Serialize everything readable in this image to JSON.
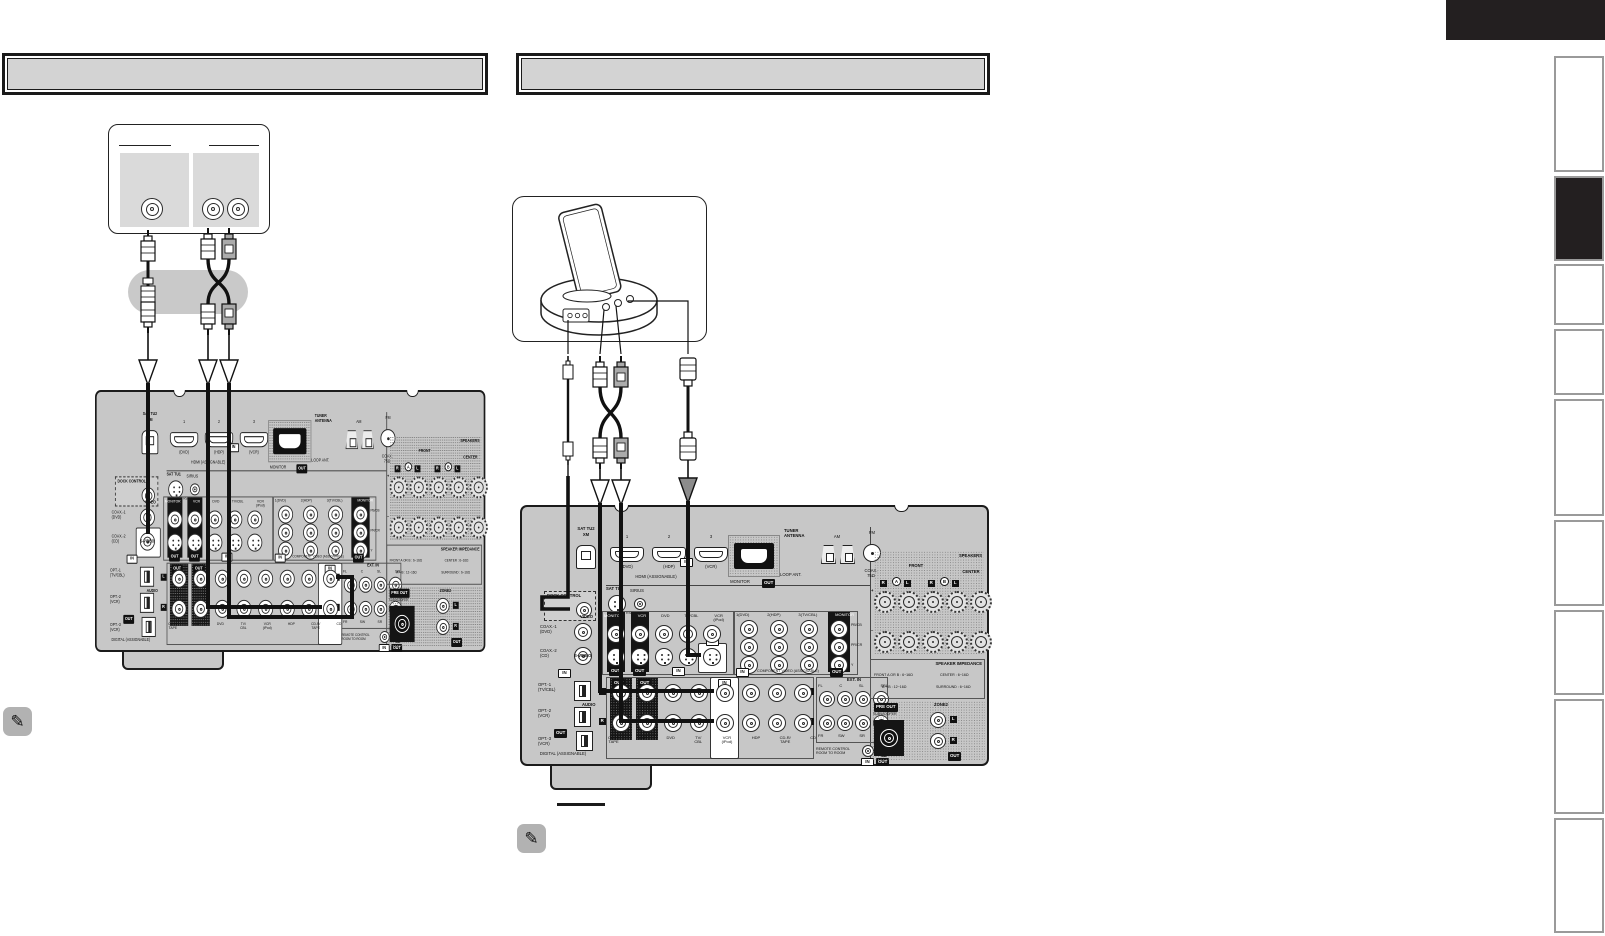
{
  "page": {
    "headers": [
      {
        "title": ""
      },
      {
        "title": ""
      }
    ],
    "top_corner_tab": {
      "color": "#231f20"
    },
    "sidebar": {
      "tab_count": 9,
      "active_tab_index": 2,
      "border_color": "#9a9a9a",
      "active_color": "#231f20"
    },
    "notes": {
      "icon": "✎"
    }
  },
  "left_diagram": {
    "player_jacks": 3,
    "cables": [
      "coaxial-digital",
      "stereo-audio"
    ]
  },
  "right_diagram": {
    "dock_jacks": 3,
    "cables": [
      "dock-control",
      "stereo-audio",
      "s-video"
    ]
  },
  "receiver": {
    "xm": {
      "label1": "SAT TU2",
      "label2": "XM"
    },
    "hdmi": {
      "ports": [
        {
          "num": "1",
          "sub": "(DVD)"
        },
        {
          "num": "2",
          "sub": "(HDP)"
        },
        {
          "num": "3",
          "sub": "(VCR)"
        }
      ],
      "group": "HDMI (ASSIGNABLE)",
      "monitor": "MONITOR"
    },
    "badges": {
      "in": "IN",
      "out": "OUT",
      "l": "L",
      "r": "R"
    },
    "tuner": {
      "title": "TUNER\nANTENNA",
      "am": "AM",
      "fm": "FM",
      "loop": "LOOP ANT.",
      "coax": "COAX.\n75Ω"
    },
    "speakers": {
      "title": "SPEAKERS",
      "front": "FRONT",
      "center": "CENTER",
      "a": "A",
      "b": "B",
      "plus": "+",
      "minus": "−"
    },
    "dock": {
      "label": "DOCK CONTROL"
    },
    "digital": {
      "coax1": "COAX.-1\n(DVD)",
      "coax2": "COAX.-2\n(CD)",
      "opt1": "OPT.-1\n(TV/CBL)",
      "opt2": "OPT.-2\n(VCR)",
      "opt3": "OPT.-3\n(VCR)",
      "group": "DIGITAL (ASSIGNABLE)"
    },
    "sat": {
      "label": "SAT TU1",
      "sirius": "SIRIUS",
      "rc": "RS/RC 2WAY"
    },
    "video": {
      "label": "VIDEO",
      "svideo": "S-VIDEO",
      "columns": [
        "MONITOR",
        "VCR",
        "DVD",
        "TV/CBL",
        "VCR\n(iPod)"
      ]
    },
    "component": {
      "columns": [
        "1(DVD)",
        "2(HDP)",
        "3(TV/CBL)",
        "MONITOR"
      ],
      "rows": [
        "PB/CB",
        "PR/CR",
        "Y"
      ],
      "caption": "COMPONENT VIDEO (ASSIGNABLE)"
    },
    "audio": {
      "label": "AUDIO",
      "columns": [
        "CD-R/\nTAPE",
        "VCR",
        "DVD",
        "TV/\nCBL",
        "VCR\n(iPod)",
        "HDP",
        "CD-R/\nTAPE",
        "CD"
      ]
    },
    "ext_in": {
      "label": "EXT. IN",
      "top": [
        "FL",
        "C",
        "SL",
        "SBL"
      ],
      "bottom": [
        "FR",
        "SW",
        "SR",
        "SBR"
      ]
    },
    "impedance": {
      "title": "SPEAKER IMPEDANCE",
      "rows": [
        [
          "FRONT A OR B : 6~16Ω",
          "CENTER : 6~16Ω"
        ],
        [
          "A + B : 12~16Ω",
          "SURROUND : 6~16Ω"
        ]
      ]
    },
    "preout": {
      "label": "PRE OUT",
      "sub": "SUBWOOFER"
    },
    "zone2": {
      "label": "ZONE2"
    },
    "remote": {
      "label": "REMOTE CONTROL\nROOM TO ROOM"
    }
  },
  "colors": {
    "chassis": "#c7c7c7",
    "highlight": "#ffffff",
    "ink": "#1b1b1b",
    "header_fill": "#d3d3d3",
    "note_bg": "#b2b2b2"
  }
}
